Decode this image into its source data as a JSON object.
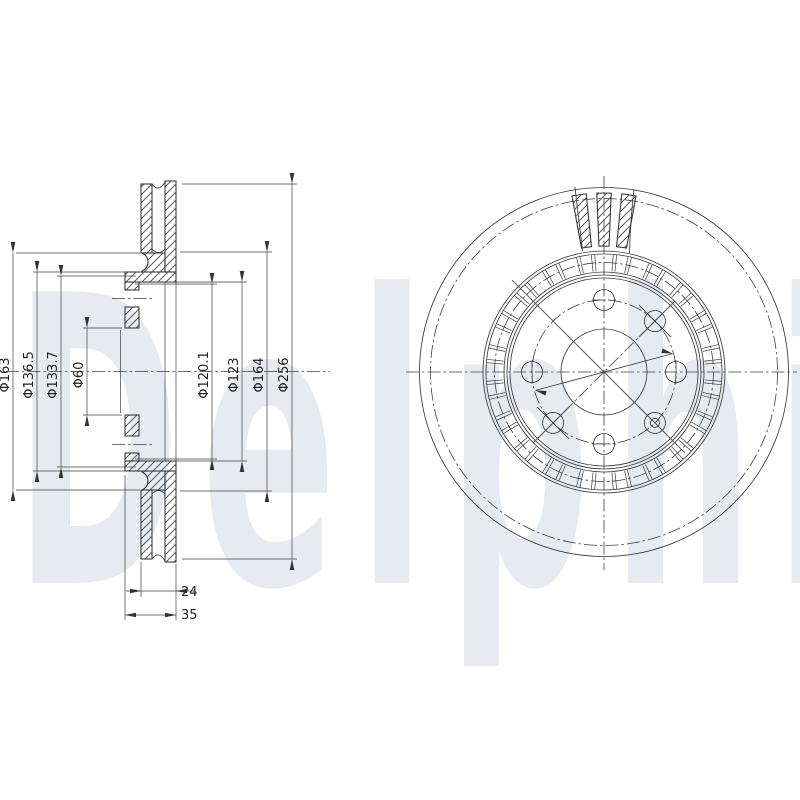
{
  "watermark": {
    "text": "Delphi"
  },
  "dimensions": {
    "left": [
      {
        "label": "Φ163"
      },
      {
        "label": "Φ136.5"
      },
      {
        "label": "Φ133.7"
      },
      {
        "label": "Φ60"
      }
    ],
    "right": [
      {
        "label": "Φ120.1"
      },
      {
        "label": "Φ123"
      },
      {
        "label": "Φ164"
      },
      {
        "label": "Φ256"
      }
    ],
    "bottom": [
      {
        "label": "24"
      },
      {
        "label": "35"
      }
    ]
  }
}
